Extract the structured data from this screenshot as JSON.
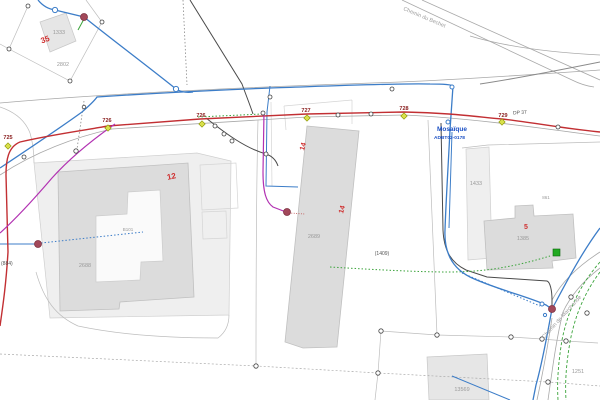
{
  "map_type": "cadastral-utility-network-map",
  "streets": [
    "Chemin du Bechet",
    "Chemin de Marchande"
  ],
  "road_reference": "DP 37",
  "network_node": {
    "name": "Mosaïque",
    "code": "ADBT02-0178"
  },
  "line_point_numbers": [
    "725",
    "726",
    "726",
    "727",
    "728",
    "729"
  ],
  "cable_references": [
    "(884)",
    "(1409)"
  ],
  "red_plot_numbers": [
    "35",
    "12",
    "14",
    "14",
    "5"
  ],
  "parcel_numbers": [
    "1333",
    "2802",
    "2688",
    "B101",
    "2689",
    "1433",
    "861",
    "1385",
    "13569",
    "1251"
  ],
  "colors": {
    "red_line": "#c22f33",
    "magenta_line": "#b232b2",
    "blue_line": "#3c7dc8",
    "green_line": "#3aa33a",
    "dark_line": "#4a4a4a",
    "node_fill": "#a2485a",
    "diamond_fill": "#d9e04b",
    "building_fill": "#dcdcdc",
    "parcel_fill": "#efefef",
    "green_marker": "#22aa22"
  }
}
